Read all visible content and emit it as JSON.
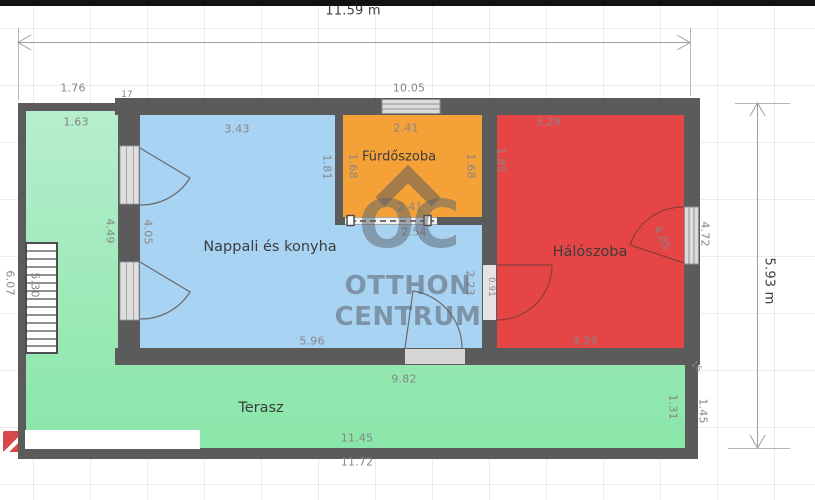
{
  "watermark": {
    "logo": "OC",
    "line1": "OTTHON",
    "line2": "CENTRUM"
  },
  "plan": {
    "overall": {
      "width_label": "11.59 m",
      "height_label": "5.93 m",
      "top_inner_width": "10.05",
      "bottom_inner_width": "9.82",
      "wall_thickness_top_left": "17",
      "wall_thickness_bottom_right": "16"
    },
    "rooms": {
      "living": {
        "name": "Nappali és konyha",
        "top_width": "3.43",
        "bottom_width": "5.96",
        "left_height": "4.05",
        "right_height": "2.23",
        "upper_right_height": "1.81"
      },
      "bathroom": {
        "name": "Fürdőszoba",
        "top_width": "2.41",
        "bottom_width": "2.41",
        "left_height": "1.68",
        "right_height": "1.68",
        "below_width": "2.54"
      },
      "bedroom": {
        "name": "Hálószoba",
        "top_width": "3.29",
        "bottom_width": "3.29",
        "left_height": "1.85",
        "door_width": "0.91",
        "window_dim": "4.05",
        "right_window_height": "4.72"
      },
      "terrace": {
        "name": "Terasz",
        "left_top_width": "1.76",
        "left_inner_width": "1.63",
        "left_height": "4.49",
        "stairs_length": "5.30",
        "outer_left_height": "6.07",
        "bottom_inner_width": "11.45",
        "bottom_outer_width": "11.72",
        "right_inner_height": "1.31",
        "right_outer_height": "1.45"
      }
    }
  },
  "colors": {
    "wall": "#5b5b5b",
    "living": "#a9d3f3",
    "bathroom": "#f4a238",
    "bedroom": "#e64545",
    "terrace_light": "#b6eecd",
    "terrace": "#8ae6a9",
    "opening": "#dcdcdc",
    "dim_text": "#868686",
    "room_text": "#3c3c3c",
    "watermark": "#5a626c"
  }
}
